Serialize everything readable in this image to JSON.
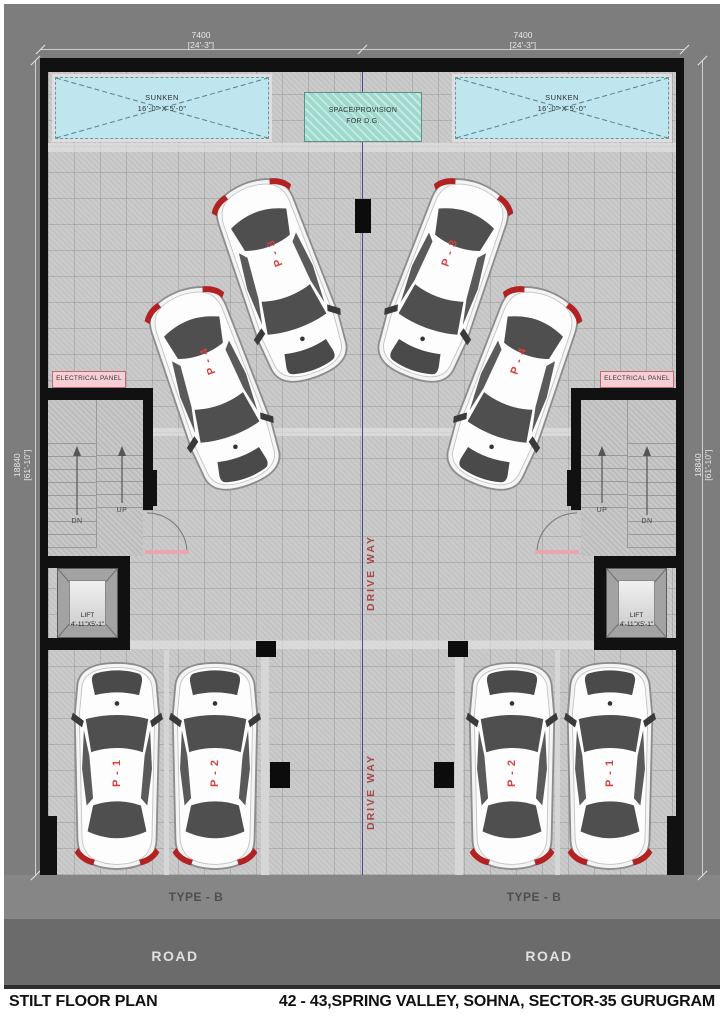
{
  "colors": {
    "background": "#7d7d7d",
    "road": "#6b6b6b",
    "floor_tile": "#c9c9c9",
    "wall": "#111111",
    "sunken_fill": "#bfe6ef",
    "dg_fill": "#a5dbd1",
    "electrical_panel_fill": "#f6ced3",
    "car_label_red": "#d84040",
    "driveway_red": "#a34848"
  },
  "dimensions": {
    "top_left": {
      "mm": "7400",
      "ft": "[24'-3\"]"
    },
    "top_right": {
      "mm": "7400",
      "ft": "[24'-3\"]"
    },
    "left": {
      "mm": "18840",
      "ft": "[61'-10\"]"
    },
    "right": {
      "mm": "18840",
      "ft": "[61'-10\"]"
    }
  },
  "zones": {
    "sunken_left": {
      "line1": "SUNKEN",
      "line2": "16'-0\" X 5'-0\""
    },
    "sunken_right": {
      "line1": "SUNKEN",
      "line2": "16'-0\" X 5'-0\""
    },
    "dg": {
      "line1": "SPACE/PROVISION",
      "line2": "FOR D.G."
    },
    "electrical_left": "ELECTRICAL PANEL",
    "electrical_right": "ELECTRICAL PANEL",
    "lift_left": {
      "line1": "LIFT",
      "line2": "4'-11\"X5'-1\""
    },
    "lift_right": {
      "line1": "LIFT",
      "line2": "4'-11\"X5'-1\""
    },
    "type_left": "TYPE - B",
    "type_right": "TYPE - B",
    "road_left": "ROAD",
    "road_right": "ROAD"
  },
  "stairs": {
    "left": {
      "outer": "DN",
      "inner": "UP"
    },
    "right": {
      "inner": "UP",
      "outer": "DN"
    }
  },
  "driveway": {
    "upper": "DRIVE WAY",
    "lower": "DRIVE WAY"
  },
  "parking": [
    {
      "label": "P - 3"
    },
    {
      "label": "P - 4"
    },
    {
      "label": "P - 3"
    },
    {
      "label": "P - 4"
    },
    {
      "label": "P - 1"
    },
    {
      "label": "P - 2"
    },
    {
      "label": "P - 2"
    },
    {
      "label": "P - 1"
    }
  ],
  "title_block": {
    "plan_name": "STILT FLOOR PLAN",
    "project": "42 - 43,SPRING VALLEY, SOHNA, SECTOR-35 GURUGRAM"
  }
}
